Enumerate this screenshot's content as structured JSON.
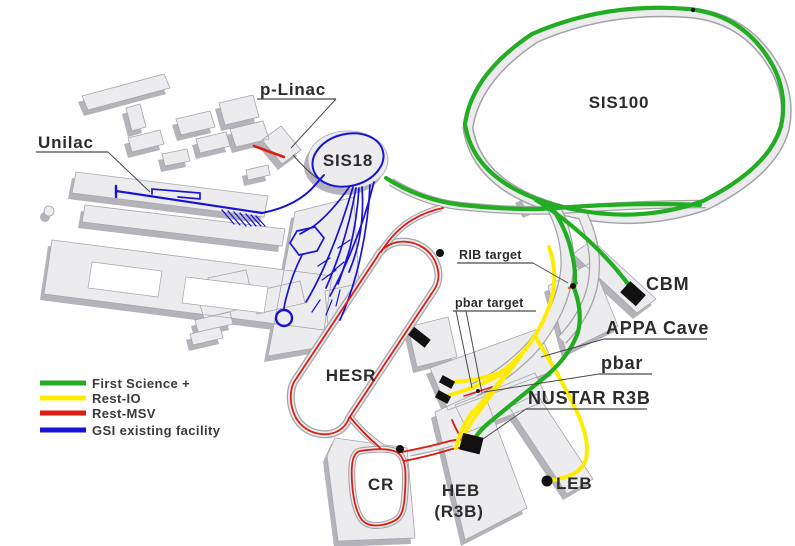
{
  "legend": {
    "items": [
      {
        "label": "First Science +",
        "color": "#22ad22"
      },
      {
        "label": "Rest-IO",
        "color": "#ffec00"
      },
      {
        "label": "Rest-MSV",
        "color": "#e01c12"
      },
      {
        "label": "GSI existing facility",
        "color": "#1713d6"
      }
    ]
  },
  "labels": {
    "unilac": "Unilac",
    "p_linac": "p-Linac",
    "sis18": "SIS18",
    "sis100": "SIS100",
    "cbm": "CBM",
    "rib_target": "RIB target",
    "pbar_target": "pbar target",
    "appa_cave": "APPA Cave",
    "pbar": "pbar",
    "nustar_r3b": "NUSTAR R3B",
    "hesr": "HESR",
    "cr": "CR",
    "heb": "HEB",
    "heb_sub": "(R3B)",
    "leb": "LEB"
  }
}
